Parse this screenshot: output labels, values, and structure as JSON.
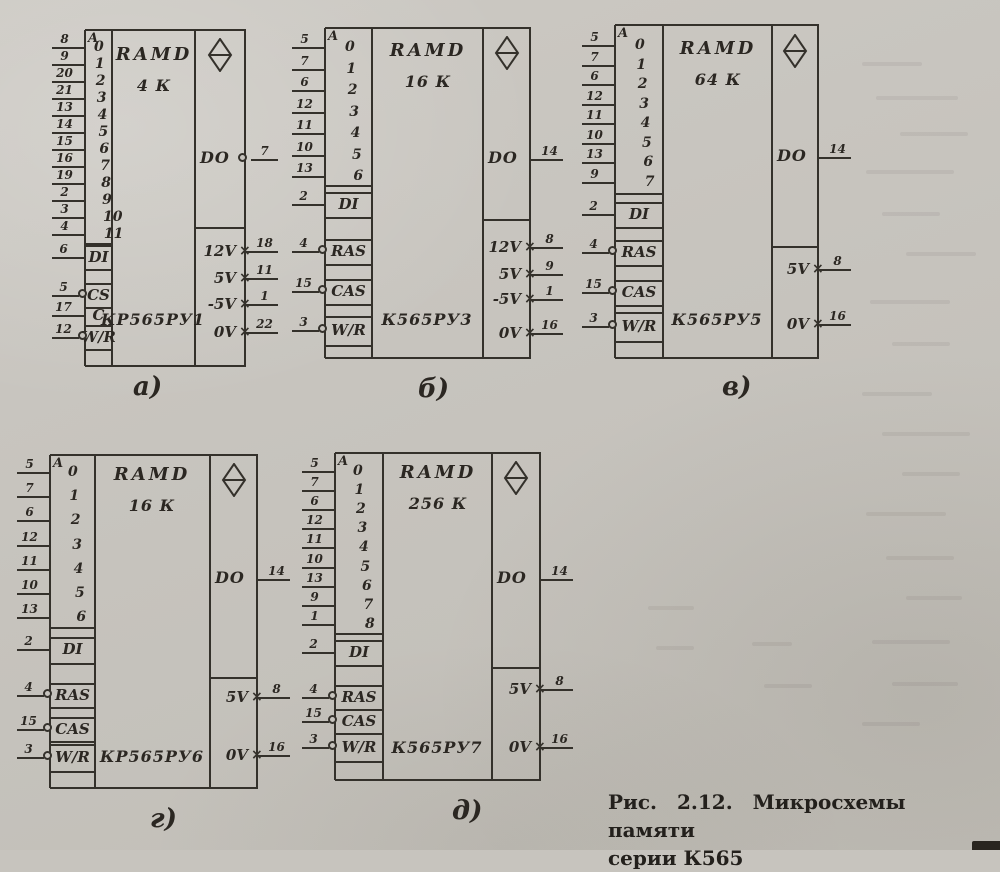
{
  "figure": {
    "caption_line1": "Рис. 2.12. Микросхемы памяти",
    "caption_line2": "серии К565"
  },
  "icons": {
    "output_symbol": "three-state-output-diamond-icon",
    "inversion_marker": "inversion-circle-icon",
    "power_marker": "non-logic-pin-cross-icon"
  },
  "line_color": "#34312b",
  "chips": [
    {
      "key": "a",
      "label": "а)",
      "block_name": "RAMD",
      "capacity": "4 К",
      "part_number": "КР565РУ1",
      "address_label": "A",
      "address_pins": [
        {
          "pin": "8",
          "bit": "0"
        },
        {
          "pin": "9",
          "bit": "1"
        },
        {
          "pin": "20",
          "bit": "2"
        },
        {
          "pin": "21",
          "bit": "3"
        },
        {
          "pin": "13",
          "bit": "4"
        },
        {
          "pin": "14",
          "bit": "5"
        },
        {
          "pin": "15",
          "bit": "6"
        },
        {
          "pin": "16",
          "bit": "7"
        },
        {
          "pin": "19",
          "bit": "8"
        },
        {
          "pin": "2",
          "bit": "9"
        },
        {
          "pin": "3",
          "bit": "10"
        },
        {
          "pin": "4",
          "bit": "11"
        }
      ],
      "cells": [
        {
          "label": "DI",
          "pin": "6",
          "inverted": false
        },
        {
          "label": "CS",
          "pin": "5",
          "inverted": true
        },
        {
          "label": "C",
          "pin": "17",
          "inverted": false
        },
        {
          "label": "W/R",
          "pin": "12",
          "inverted": true
        }
      ],
      "data_out": {
        "label": "DO",
        "pin": "7",
        "circle": true
      },
      "power_pins": [
        {
          "label": "12V",
          "pin": "18"
        },
        {
          "label": "5V",
          "pin": "11"
        },
        {
          "label": "-5V",
          "pin": "1"
        },
        {
          "label": "0V",
          "pin": "22"
        }
      ]
    },
    {
      "key": "b",
      "label": "б)",
      "block_name": "RAMD",
      "capacity": "16 К",
      "part_number": "К565РУ3",
      "address_label": "A",
      "address_pins": [
        {
          "pin": "5",
          "bit": "0"
        },
        {
          "pin": "7",
          "bit": "1"
        },
        {
          "pin": "6",
          "bit": "2"
        },
        {
          "pin": "12",
          "bit": "3"
        },
        {
          "pin": "11",
          "bit": "4"
        },
        {
          "pin": "10",
          "bit": "5"
        },
        {
          "pin": "13",
          "bit": "6"
        }
      ],
      "cells": [
        {
          "label": "DI",
          "pin": "2",
          "inverted": false
        },
        {
          "label": "RAS",
          "pin": "4",
          "inverted": true
        },
        {
          "label": "CAS",
          "pin": "15",
          "inverted": true
        },
        {
          "label": "W/R",
          "pin": "3",
          "inverted": true
        }
      ],
      "data_out": {
        "label": "DO",
        "pin": "14",
        "circle": false
      },
      "power_pins": [
        {
          "label": "12V",
          "pin": "8"
        },
        {
          "label": "5V",
          "pin": "9"
        },
        {
          "label": "-5V",
          "pin": "1"
        },
        {
          "label": "0V",
          "pin": "16"
        }
      ]
    },
    {
      "key": "v",
      "label": "в)",
      "block_name": "RAMD",
      "capacity": "64 К",
      "part_number": "К565РУ5",
      "address_label": "A",
      "address_pins": [
        {
          "pin": "5",
          "bit": "0"
        },
        {
          "pin": "7",
          "bit": "1"
        },
        {
          "pin": "6",
          "bit": "2"
        },
        {
          "pin": "12",
          "bit": "3"
        },
        {
          "pin": "11",
          "bit": "4"
        },
        {
          "pin": "10",
          "bit": "5"
        },
        {
          "pin": "13",
          "bit": "6"
        },
        {
          "pin": "9",
          "bit": "7"
        }
      ],
      "cells": [
        {
          "label": "DI",
          "pin": "2",
          "inverted": false
        },
        {
          "label": "RAS",
          "pin": "4",
          "inverted": true
        },
        {
          "label": "CAS",
          "pin": "15",
          "inverted": true
        },
        {
          "label": "W/R",
          "pin": "3",
          "inverted": true
        }
      ],
      "data_out": {
        "label": "DO",
        "pin": "14",
        "circle": false
      },
      "power_pins": [
        {
          "label": "5V",
          "pin": "8"
        },
        {
          "label": "0V",
          "pin": "16"
        }
      ]
    },
    {
      "key": "g",
      "label": "г)",
      "block_name": "RAMD",
      "capacity": "16 К",
      "part_number": "КР565РУ6",
      "address_label": "A",
      "address_pins": [
        {
          "pin": "5",
          "bit": "0"
        },
        {
          "pin": "7",
          "bit": "1"
        },
        {
          "pin": "6",
          "bit": "2"
        },
        {
          "pin": "12",
          "bit": "3"
        },
        {
          "pin": "11",
          "bit": "4"
        },
        {
          "pin": "10",
          "bit": "5"
        },
        {
          "pin": "13",
          "bit": "6"
        }
      ],
      "cells": [
        {
          "label": "DI",
          "pin": "2",
          "inverted": false
        },
        {
          "label": "RAS",
          "pin": "4",
          "inverted": true
        },
        {
          "label": "CAS",
          "pin": "15",
          "inverted": true
        },
        {
          "label": "W/R",
          "pin": "3",
          "inverted": true
        }
      ],
      "data_out": {
        "label": "DO",
        "pin": "14",
        "circle": false
      },
      "power_pins": [
        {
          "label": "5V",
          "pin": "8"
        },
        {
          "label": "0V",
          "pin": "16"
        }
      ]
    },
    {
      "key": "d",
      "label": "д)",
      "block_name": "RAMD",
      "capacity": "256 К",
      "part_number": "К565РУ7",
      "address_label": "A",
      "address_pins": [
        {
          "pin": "5",
          "bit": "0"
        },
        {
          "pin": "7",
          "bit": "1"
        },
        {
          "pin": "6",
          "bit": "2"
        },
        {
          "pin": "12",
          "bit": "3"
        },
        {
          "pin": "11",
          "bit": "4"
        },
        {
          "pin": "10",
          "bit": "5"
        },
        {
          "pin": "13",
          "bit": "6"
        },
        {
          "pin": "9",
          "bit": "7"
        },
        {
          "pin": "1",
          "bit": "8"
        }
      ],
      "cells": [
        {
          "label": "DI",
          "pin": "2",
          "inverted": false
        },
        {
          "label": "RAS",
          "pin": "4",
          "inverted": true
        },
        {
          "label": "CAS",
          "pin": "15",
          "inverted": true
        },
        {
          "label": "W/R",
          "pin": "3",
          "inverted": true
        }
      ],
      "data_out": {
        "label": "DO",
        "pin": "14",
        "circle": false
      },
      "power_pins": [
        {
          "label": "5V",
          "pin": "8"
        },
        {
          "label": "0V",
          "pin": "16"
        }
      ]
    }
  ]
}
